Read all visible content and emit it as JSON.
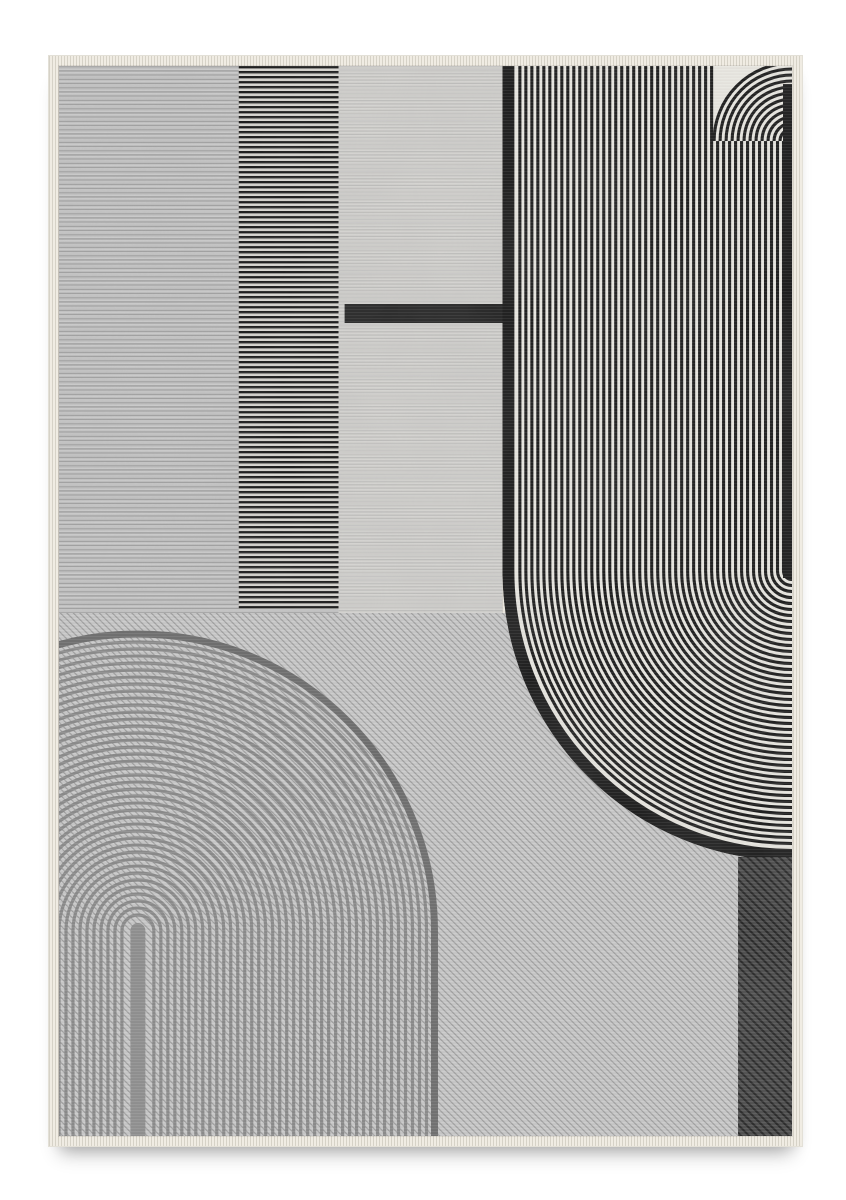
{
  "scene": {
    "description": "Product photo of a rectangular flat-weave area rug with abstract black, gray and ivory art-deco line motifs on a white background",
    "page_bg": "#ffffff"
  },
  "rug": {
    "palette": {
      "fringe": "#f0ece3",
      "panel_left_bg": "#c7c7c7",
      "panel_left_line": "#a3a3a3",
      "column_bg": "#d8d6d1",
      "column_stripe": "#191919",
      "panel_mid_bg": "#d3d2cf",
      "panel_mid_line": "rgba(150,150,150,0.30)",
      "black_bar": "#262626",
      "field_bg": "#eae8e2",
      "field_stripe": "#1c1c1c",
      "diag_bg": "#cbcbcb",
      "diag_line": "#9e9e9e",
      "arch_ring": "#8a8a8a",
      "arch_outer_ring": "#6d6d6d",
      "arch_bar": "#8f8f8f",
      "patch_bg": "#4d4d4d",
      "patch_line": "#262626",
      "weave_light": "rgba(255,255,255,0.07)",
      "weave_dark": "rgba(0,0,0,0.045)"
    },
    "canvas": {
      "width": 734,
      "height": 1070
    },
    "panels": {
      "blocks_bottom": 547,
      "left_block": {
        "x": 0,
        "y": 0,
        "w": 280,
        "h": 547,
        "line_period": 4.2,
        "line_width": 1.35
      },
      "stripe_column": {
        "x": 180,
        "y": 0,
        "w": 100,
        "h": 543,
        "stripe_period": 5,
        "stripe_width": 2.4
      },
      "mid_block": {
        "x": 280,
        "y": 0,
        "w": 164,
        "h": 547,
        "line_period": 3.4,
        "line_width": 0.9
      },
      "black_bar": {
        "x": 286,
        "y": 238,
        "w": 164,
        "h": 19
      }
    },
    "stripe_field": {
      "x": 444,
      "right": 734,
      "top": 0,
      "bend_center_y": 505,
      "fan_center_y": 75,
      "fan_max_radius": 78,
      "stripe_period": 6,
      "stripe_width": 3.1,
      "band_width": 12,
      "band_arc_radius": 284,
      "outer_arc_radius": 290,
      "edge_band": {
        "x": 725,
        "y": 18,
        "w": 9,
        "h": 494
      }
    },
    "diagonal_field": {
      "x": 0,
      "y": 547,
      "w": 734,
      "h": 523,
      "line_period": 4.6,
      "line_width": 1.15
    },
    "arch": {
      "cx": 79,
      "base_y": 865,
      "bottom": 1070,
      "ring_start": 16,
      "ring_step": 7,
      "ring_end": 290,
      "ring_width": 3.2,
      "outer_ring_radius": 297,
      "outer_ring_width": 7,
      "bar_half_width": 7.5,
      "bar_top": 864.5
    },
    "corner_patch": {
      "x": 680,
      "y": 791,
      "w": 54,
      "h": 279,
      "line_period": 5.6,
      "line_width": 2
    },
    "weave": {
      "period": 3,
      "light_h": 1,
      "dark_y": 1.7,
      "dark_h": 0.8
    },
    "mottle": {
      "base_frequency": "0.014 0.011",
      "octaves": 3,
      "seed": 8,
      "opacity": 0.22
    }
  }
}
